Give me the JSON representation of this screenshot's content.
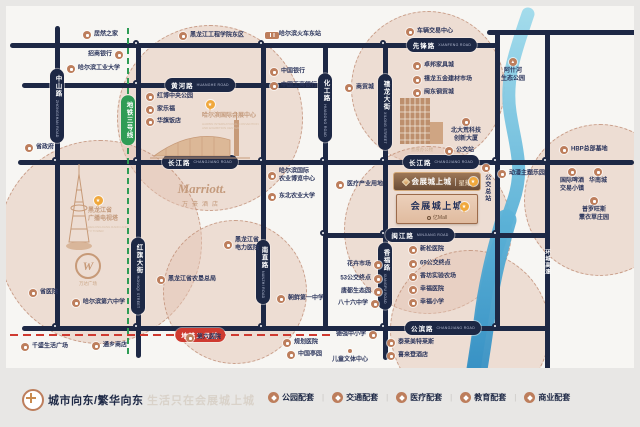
{
  "colors": {
    "road": "#1d2845",
    "poi_icon": "#bd7e5c",
    "circle_fill": "#e4c4b4",
    "metro3": "#2f9c55",
    "metro2": "#cf3a30",
    "river": "#2a85bd",
    "gold": "#f0a83c",
    "banner": "#6a4c36"
  },
  "map": {
    "circles": [
      {
        "x": 210,
        "y": 118,
        "r": 93
      },
      {
        "x": 428,
        "y": 88,
        "r": 77
      },
      {
        "x": 100,
        "y": 242,
        "r": 102
      },
      {
        "x": 428,
        "y": 230,
        "r": 84
      },
      {
        "x": 235,
        "y": 292,
        "r": 72
      },
      {
        "x": 470,
        "y": 330,
        "r": 80
      },
      {
        "x": 600,
        "y": 200,
        "r": 76
      }
    ],
    "roads": {
      "h": [
        {
          "x": 10,
          "y": 45,
          "w": 487
        },
        {
          "x": 487,
          "y": 32,
          "w": 153
        },
        {
          "x": 22,
          "y": 85,
          "w": 306
        },
        {
          "x": 18,
          "y": 162,
          "w": 616
        },
        {
          "x": 325,
          "y": 235,
          "w": 224
        },
        {
          "x": 22,
          "y": 328,
          "w": 527
        }
      ],
      "v": [
        {
          "x": 57,
          "y": 26,
          "h": 302
        },
        {
          "x": 138,
          "y": 45,
          "h": 313
        },
        {
          "x": 263,
          "y": 45,
          "h": 283
        },
        {
          "x": 325,
          "y": 45,
          "h": 283
        },
        {
          "x": 385,
          "y": 45,
          "h": 315
        },
        {
          "x": 497,
          "y": 32,
          "h": 296
        },
        {
          "x": 547,
          "y": 30,
          "h": 360
        }
      ]
    },
    "junctions": [
      {
        "x": 138,
        "y": 45
      },
      {
        "x": 263,
        "y": 45
      },
      {
        "x": 385,
        "y": 45
      },
      {
        "x": 138,
        "y": 85
      },
      {
        "x": 57,
        "y": 162
      },
      {
        "x": 138,
        "y": 162
      },
      {
        "x": 263,
        "y": 162
      },
      {
        "x": 325,
        "y": 162
      },
      {
        "x": 385,
        "y": 162
      },
      {
        "x": 497,
        "y": 162
      },
      {
        "x": 547,
        "y": 162
      },
      {
        "x": 325,
        "y": 235
      },
      {
        "x": 385,
        "y": 235
      },
      {
        "x": 497,
        "y": 235
      },
      {
        "x": 57,
        "y": 328
      },
      {
        "x": 138,
        "y": 328
      },
      {
        "x": 263,
        "y": 328
      },
      {
        "x": 385,
        "y": 328
      },
      {
        "x": 497,
        "y": 328
      }
    ],
    "road_labels": [
      {
        "cn": "先锋路",
        "en": "XIANFENG ROAD",
        "x": 442,
        "y": 45
      },
      {
        "cn": "黄河路",
        "en": "HUANGHE ROAD",
        "x": 200,
        "y": 85
      },
      {
        "cn": "长江路",
        "en": "CHANGJIANG ROAD",
        "x": 200,
        "y": 162
      },
      {
        "cn": "长江路",
        "en": "CHANGJIANG ROAD",
        "x": 441,
        "y": 162
      },
      {
        "cn": "闽江路",
        "en": "MINJIANG ROAD",
        "x": 420,
        "y": 235
      },
      {
        "cn": "公滨路",
        "en": "CHANGJIANG ROAD",
        "x": 443,
        "y": 328
      },
      {
        "cn": "中山路",
        "en": "ZHONGSHAN ROAD",
        "x": 57,
        "y": 106,
        "v": true
      },
      {
        "cn": "红旗大街",
        "en": "HONGQI STREET",
        "x": 138,
        "y": 276,
        "v": true
      },
      {
        "cn": "化工路",
        "en": "HUAGONG ROAD",
        "x": 325,
        "y": 108,
        "v": true
      },
      {
        "cn": "禧龙大街",
        "en": "XILONG STREET",
        "x": 385,
        "y": 112,
        "v": true
      },
      {
        "cn": "南直路",
        "en": "NANZHI ROAD",
        "x": 263,
        "y": 272,
        "v": true
      },
      {
        "cn": "香福路",
        "en": "XIANGFU ROAD",
        "x": 385,
        "y": 276,
        "v": true
      },
      {
        "cn": "地铁三号线",
        "x": 128,
        "y": 120,
        "v": true,
        "cls": "m3"
      },
      {
        "cn": "地铁二号线",
        "x": 200,
        "y": 335,
        "cls": "m2"
      },
      {
        "cn": "环城高速",
        "x": 547,
        "y": 262,
        "v": true,
        "cls": "ring"
      }
    ],
    "metro": {
      "line3": {
        "x": 128,
        "y1": 28,
        "y2": 356
      },
      "line2": {
        "y": 335,
        "x1": 10,
        "x2": 332
      }
    },
    "pois": [
      {
        "t": "居然之家",
        "x": 87,
        "y": 35
      },
      {
        "t": "招商银行",
        "x": 119,
        "y": 55,
        "s": "l"
      },
      {
        "t": "哈尔滨工业大学",
        "x": 71,
        "y": 69
      },
      {
        "t": "黑龙江工程学院东区",
        "x": 183,
        "y": 36
      },
      {
        "t": "哈尔滨火车东站",
        "x": 272,
        "y": 35,
        "i": "train"
      },
      {
        "t": "中国银行",
        "x": 274,
        "y": 72
      },
      {
        "t": "中国工商银行",
        "x": 274,
        "y": 86
      },
      {
        "t": "红博中央公园",
        "x": 150,
        "y": 97
      },
      {
        "t": "家乐福",
        "x": 150,
        "y": 110
      },
      {
        "t": "华旗饭店",
        "x": 150,
        "y": 122
      },
      {
        "t": "商贸城",
        "x": 349,
        "y": 88
      },
      {
        "t": "车辆交易中心",
        "x": 410,
        "y": 32
      },
      {
        "t": "卓邦家具城",
        "x": 417,
        "y": 66
      },
      {
        "t": "禧龙五金建材市场",
        "x": 417,
        "y": 80
      },
      {
        "t": "闽东钢贸城",
        "x": 417,
        "y": 93
      },
      {
        "t": "北大荒科技\n创新大厦",
        "x": 466,
        "y": 122,
        "s": "b"
      },
      {
        "t": "公交站",
        "x": 449,
        "y": 151
      },
      {
        "t": "阿什河\n生态公园",
        "x": 513,
        "y": 62,
        "s": "b",
        "i": "tree"
      },
      {
        "t": "HBP总部基地",
        "x": 564,
        "y": 150
      },
      {
        "t": "动漫主题乐园",
        "x": 502,
        "y": 174
      },
      {
        "t": "国际啤酒\n交易小镇",
        "x": 572,
        "y": 172,
        "s": "b"
      },
      {
        "t": "华南城",
        "x": 598,
        "y": 172,
        "s": "b"
      },
      {
        "t": "普罗旺斯\n薰衣草庄园",
        "x": 594,
        "y": 201,
        "s": "b"
      },
      {
        "t": "公交总站",
        "x": 486,
        "y": 168,
        "s": "v"
      },
      {
        "t": "省政府",
        "x": 29,
        "y": 148
      },
      {
        "t": "医疗产业用地",
        "x": 340,
        "y": 185
      },
      {
        "t": "哈尔滨国际\n农业博览中心",
        "x": 272,
        "y": 176
      },
      {
        "t": "东北农业大学",
        "x": 272,
        "y": 197
      },
      {
        "t": "黑龙江省\n电力医院",
        "x": 228,
        "y": 245
      },
      {
        "t": "黑龙江省农垦总局",
        "x": 161,
        "y": 280
      },
      {
        "t": "朝鲜第一中学",
        "x": 281,
        "y": 299
      },
      {
        "t": "花卉市场",
        "x": 378,
        "y": 265,
        "s": "l"
      },
      {
        "t": "53公交终点",
        "x": 378,
        "y": 279,
        "s": "l"
      },
      {
        "t": "唐都生态园",
        "x": 378,
        "y": 292,
        "s": "l"
      },
      {
        "t": "八十六中学",
        "x": 375,
        "y": 304,
        "s": "l"
      },
      {
        "t": "新松医院",
        "x": 413,
        "y": 250
      },
      {
        "t": "69公交终点",
        "x": 413,
        "y": 264
      },
      {
        "t": "香坊实验农场",
        "x": 413,
        "y": 277
      },
      {
        "t": "幸福医院",
        "x": 413,
        "y": 290
      },
      {
        "t": "幸福小学",
        "x": 413,
        "y": 303
      },
      {
        "t": "省医院",
        "x": 33,
        "y": 293
      },
      {
        "t": "哈尔滨第六中学",
        "x": 76,
        "y": 303
      },
      {
        "t": "千盛生活广场",
        "x": 25,
        "y": 347
      },
      {
        "t": "通乡商店",
        "x": 96,
        "y": 346
      },
      {
        "t": "第六医院",
        "x": 190,
        "y": 338
      },
      {
        "t": "德强中小学",
        "x": 373,
        "y": 335,
        "s": "l"
      },
      {
        "t": "儿童文体中心",
        "x": 350,
        "y": 351,
        "s": "b",
        "i": "dot"
      },
      {
        "t": "泰莱美特莱斯",
        "x": 391,
        "y": 343
      },
      {
        "t": "喜来登酒店",
        "x": 391,
        "y": 356
      },
      {
        "t": "规划医院",
        "x": 287,
        "y": 343
      },
      {
        "t": "中国亭园",
        "x": 291,
        "y": 355
      }
    ]
  },
  "landmarks": {
    "convention_center": {
      "name": "哈尔滨国际会展中心",
      "en": "HARBIN INTERNATIONAL CONVENTION AND EXHIBITION CENTER"
    },
    "tv_tower": {
      "name": "黑龙江省\n广播电视塔",
      "en": "HEILONGJIANG RADIO AND TV TOWER"
    },
    "wanda": {
      "glyph": "W",
      "name": "万达广场"
    },
    "marriott": {
      "name": "Marriott.",
      "sub": "万豪酒店"
    },
    "exhibition_office": {
      "name": "会展办公楼"
    }
  },
  "project": {
    "banner_name": "会展城上城",
    "banner_sub": "星耀",
    "name": "会展城上城",
    "sub": "亿Mall"
  },
  "footer": {
    "slogan_bold": "城市向东/繁华向东",
    "slogan_light": "生活只在会展城上城",
    "separator": "|",
    "legend": [
      {
        "label": "公园配套",
        "icon": "park-icon"
      },
      {
        "label": "交通配套",
        "icon": "transport-icon"
      },
      {
        "label": "医疗配套",
        "icon": "medical-icon"
      },
      {
        "label": "教育配套",
        "icon": "education-icon"
      },
      {
        "label": "商业配套",
        "icon": "business-icon"
      }
    ]
  }
}
